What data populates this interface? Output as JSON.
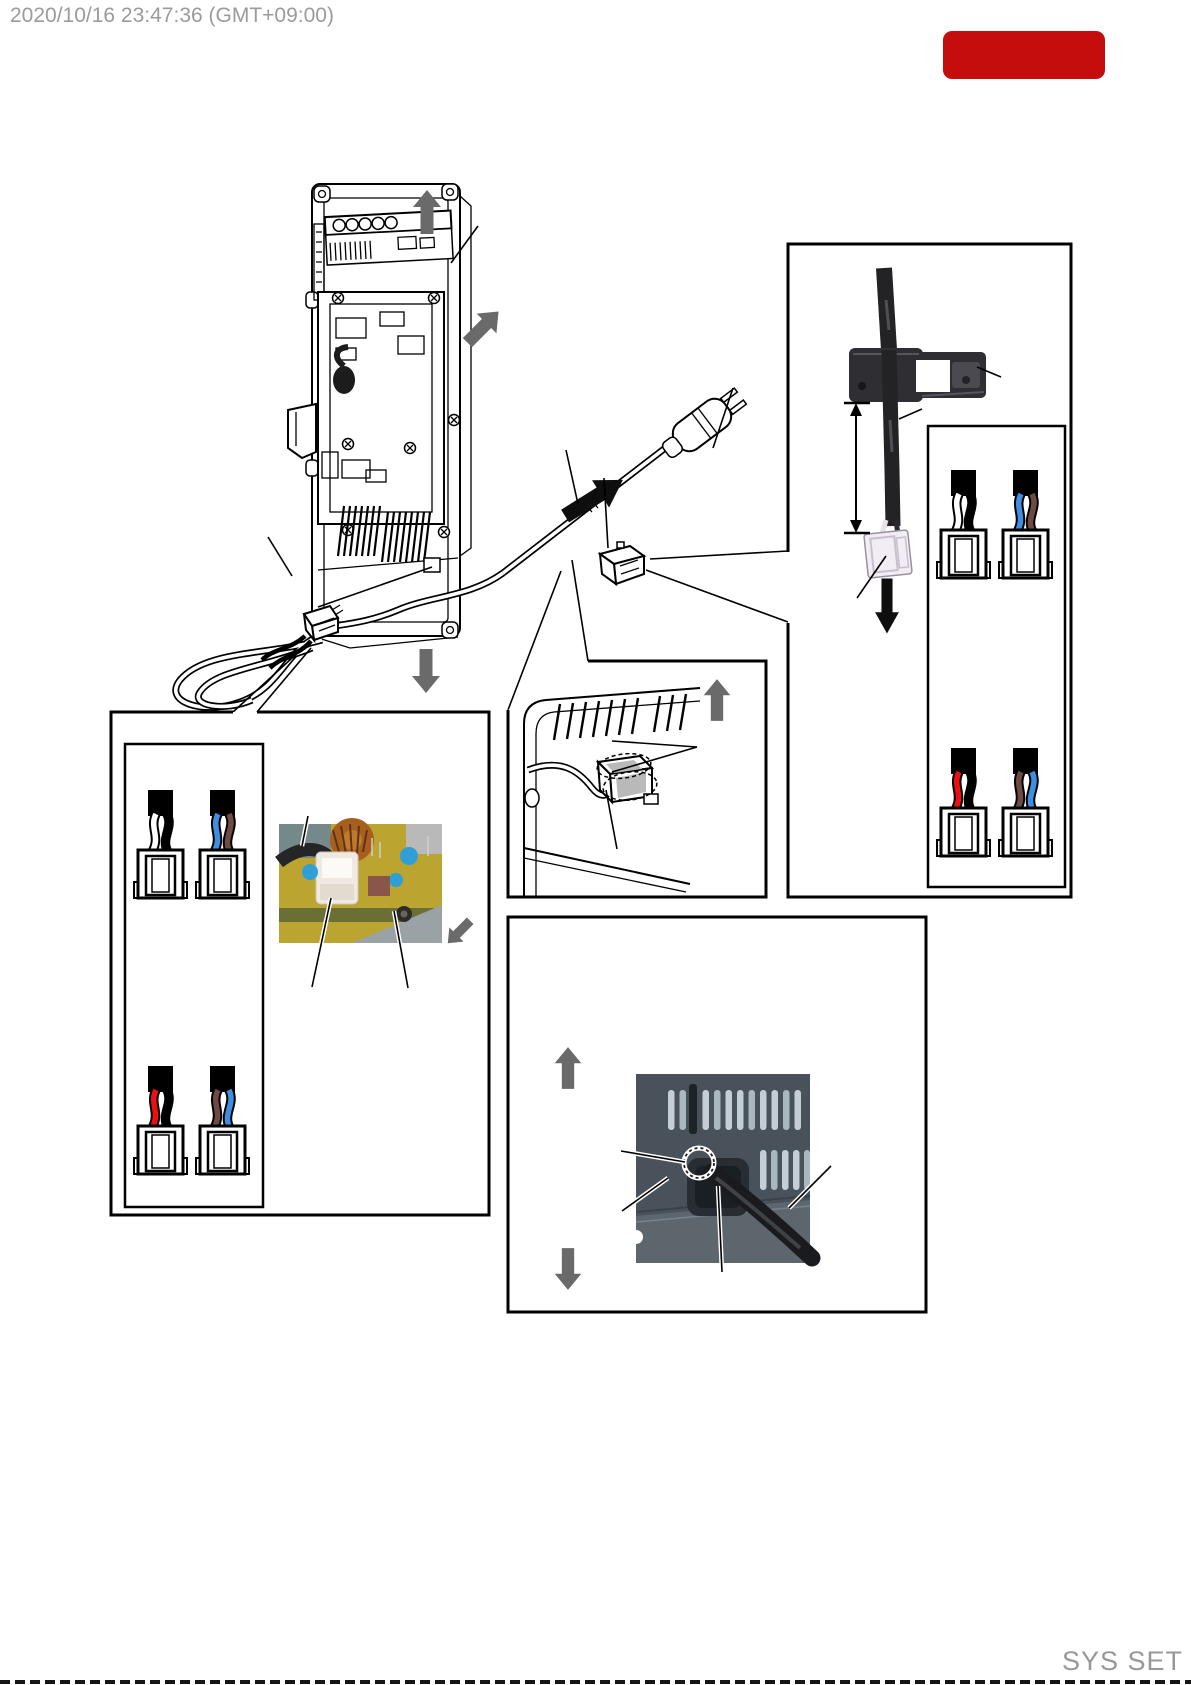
{
  "page": {
    "width": 1191,
    "height": 1685,
    "background": "#ffffff"
  },
  "header": {
    "timestamp": "2020/10/16 23:47:36 (GMT+09:00)",
    "timestamp_color": "#9b9b9b",
    "badge_color": "#c50d0d"
  },
  "footer": {
    "label": "SYS SET",
    "color": "#989898"
  },
  "colors": {
    "line": "#000000",
    "arrow_gray": "#6a6a6a",
    "arrow_black": "#0e0e0e"
  },
  "wiring": {
    "right_box": [
      {
        "position": "top-left",
        "wire_colors": [
          "#ffffff",
          "#000000"
        ]
      },
      {
        "position": "top-right",
        "wire_colors": [
          "#3e8ee2",
          "#6f4a44"
        ]
      },
      {
        "position": "bottom-left",
        "wire_colors": [
          "#ee1010",
          "#000000"
        ]
      },
      {
        "position": "bottom-right",
        "wire_colors": [
          "#6f4a44",
          "#3e8ee2"
        ]
      }
    ],
    "left_box": [
      {
        "position": "top-left",
        "wire_colors": [
          "#ffffff",
          "#000000"
        ]
      },
      {
        "position": "top-right",
        "wire_colors": [
          "#3e8ee2",
          "#6f4a44"
        ]
      },
      {
        "position": "bottom-left",
        "wire_colors": [
          "#ee1010",
          "#000000"
        ]
      },
      {
        "position": "bottom-right",
        "wire_colors": [
          "#6f4a44",
          "#3e8ee2"
        ]
      }
    ]
  },
  "photos": {
    "cord_clamp": {
      "cable_color": "#232326",
      "clamp_color": "#2e2e33",
      "connector_color": "#f2ecf4"
    },
    "noise_filter_pcb": {
      "board_color": "#bba42f",
      "coil_color": "#a85f1e",
      "capacitor_color": "#2f9fd6"
    },
    "rear_panel": {
      "panel_color": "#49525a",
      "vent_color": "#c3cfd4",
      "cord_color": "#191b1e",
      "highlight_ring": "#ffffff"
    }
  }
}
